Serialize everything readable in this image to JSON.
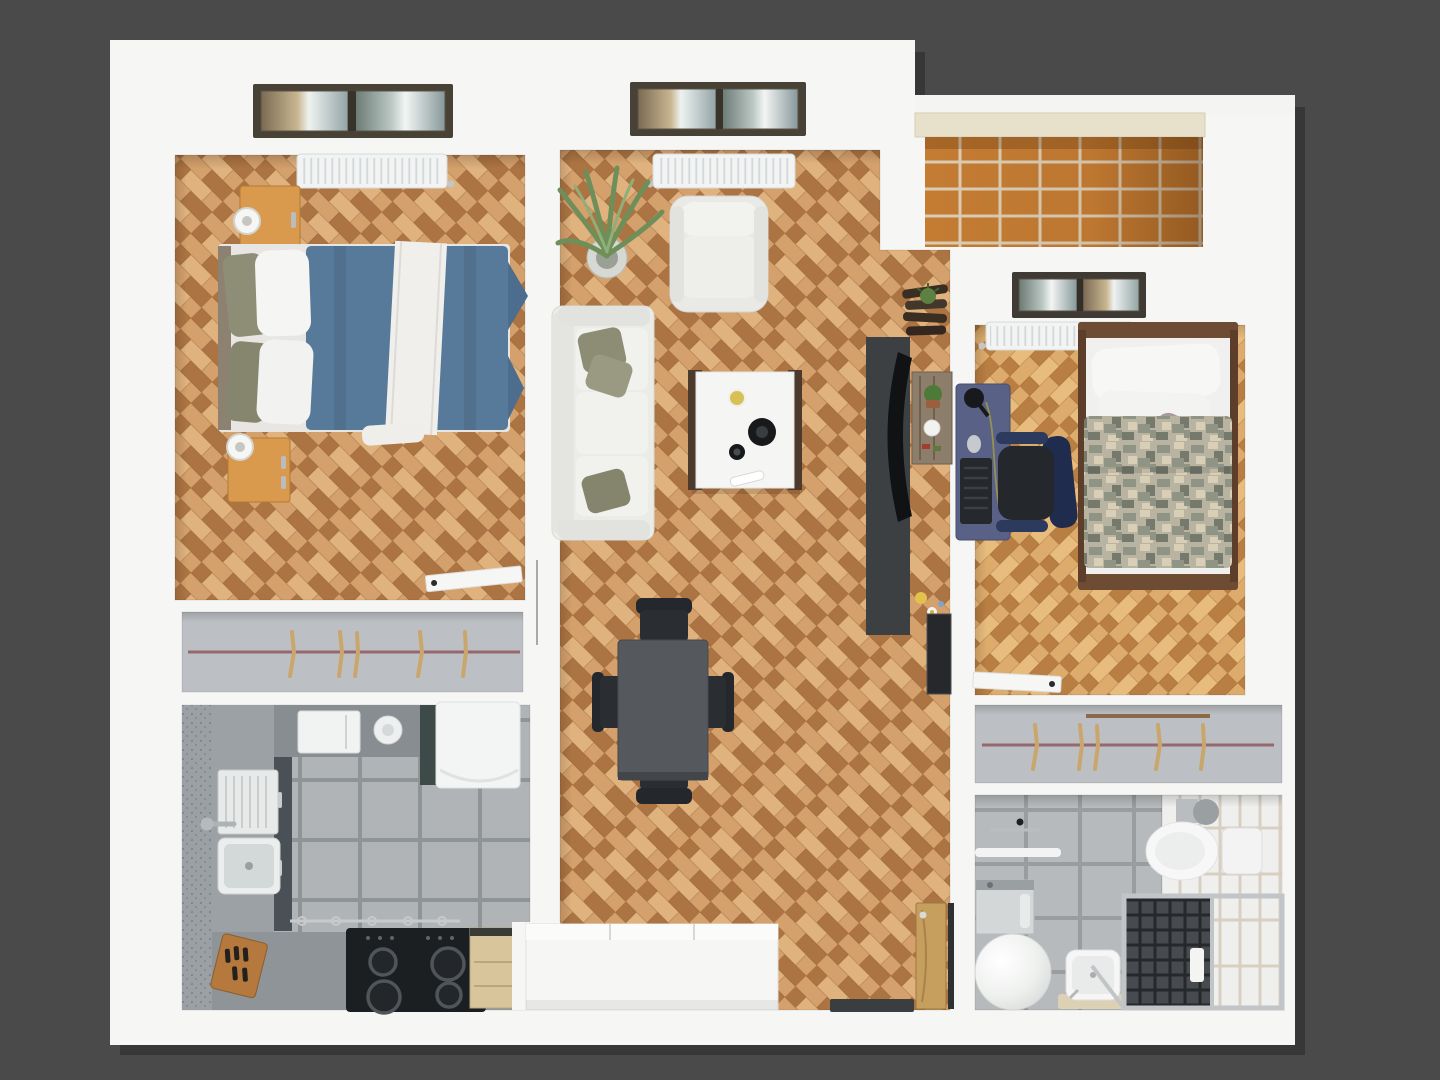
{
  "scene": {
    "description": "Top-down 3D architectural render of a two-bedroom apartment floor plan on a dark gray background. No text labels are visible in the image.",
    "view": "top-down 3D floor plan",
    "background_color": "#4a4a4b"
  },
  "palette": {
    "background": "#4a4a4b",
    "wall": "#f6f6f5",
    "parquet_light": "#d4a06b",
    "parquet_mid": "#c08a55",
    "parquet_dark": "#ad7443",
    "parquet_warm": "#e0b27e",
    "parquet2_light": "#ddab6b",
    "parquet2_mid": "#cb9454",
    "parquet2_dark": "#b87e42",
    "parquet2_warm": "#e8bc7d",
    "kitchen_tile": "#b0b4b7",
    "kitchen_grout": "#8f9497",
    "counter": "#9ba1a5",
    "counter_dark": "#878d90",
    "cabinet_dark": "#4a5156",
    "bath_tile": "#b6babc",
    "bath_grout": "#999da0",
    "white_tile": "#eff0ee",
    "white_tile_grout": "#d8cfc3",
    "balcony_tile": "#c47c33",
    "balcony_grout": "#dbccb4",
    "duvet_blue": "#587a9a",
    "duvet_blue_dark": "#4c6d8d",
    "camo_base": "#b8b4a1",
    "camo_green": "#8f9484",
    "camo_sand": "#d8cfb6",
    "camo_dark": "#757a6c",
    "wood_nightstand": "#d99a4e",
    "wood_bedframe": "#6e4b33",
    "wood_door": "#c69e5e",
    "wood_hanger": "#c9a66b",
    "closet_floor": "#bcc0c4",
    "closet_rail": "#96686e",
    "sofa_white": "#ebebe8",
    "pillow_olive": "#8d8d76",
    "table_dark": "#55595d",
    "chair_black": "#24272c",
    "tv_console": "#3c4043",
    "tv_black": "#101214",
    "desk_blue": "#5a6186",
    "chair_navy": "#2c3a5e",
    "radiator": "#f2f3f3",
    "window_frame": "#474136",
    "stove_black": "#1c1f22",
    "plant_green": "#6e8f5a",
    "mat_beige": "#ddd1b5"
  },
  "rooms": [
    {
      "id": "bedroom-1",
      "label": "Main bedroom with double bed",
      "floor": "herringbone parquet",
      "furniture": [
        "window",
        "white radiator",
        "double bed with blue duvet and white sheet",
        "white and olive pillows",
        "two orange wood nightstands",
        "two white table lamps",
        "open white door"
      ]
    },
    {
      "id": "living-room",
      "label": "Living room with dining area",
      "floor": "herringbone parquet",
      "furniture": [
        "window",
        "white radiator",
        "potted palm plant",
        "white armchair",
        "white three-seat sofa with olive cushions",
        "coffee table with bowls, candle and remote",
        "dark dining table with four black chairs",
        "dark TV console with curved TV",
        "rustic wall shelf with plant and mug",
        "corner spiral shelf with succulent",
        "dark wall mirror"
      ]
    },
    {
      "id": "bedroom-2",
      "label": "Second bedroom / office",
      "floor": "herringbone parquet",
      "furniture": [
        "window to balcony",
        "white radiator",
        "single bed with wooden frame and digital camo duvet",
        "white pillows and gray pillow",
        "dark blue computer desk with lamp, keyboard and mouse",
        "black office chair with navy armrests",
        "open white door"
      ]
    },
    {
      "id": "balcony",
      "label": "Balcony",
      "floor": "terracotta tiles",
      "furniture": [
        "parapet wall with cream coping"
      ]
    },
    {
      "id": "kitchen",
      "label": "Kitchen",
      "floor": "gray ceramic tiles",
      "furniture": [
        "L-shaped gray countertop",
        "sink with drainboard and chrome faucet",
        "black four-burner cooktop",
        "wooden knife block",
        "white microwave",
        "white countertop appliance",
        "white refrigerator",
        "dark lower cabinet fronts",
        "utensil rail with hooks",
        "light wood drawer unit"
      ]
    },
    {
      "id": "bathroom",
      "label": "Bathroom",
      "floor": "gray and white tiles",
      "furniture": [
        "toilet with cistern",
        "glass shower cabin with chrome frame",
        "washing machine",
        "white cylindrical water heater",
        "small white sink",
        "beige bath mat",
        "white towel rail"
      ]
    },
    {
      "id": "closet-left",
      "label": "Built-in wardrobe (left)",
      "floor": "gray",
      "furniture": [
        "clothes rail",
        "five wooden hangers"
      ]
    },
    {
      "id": "closet-right",
      "label": "Built-in wardrobe (right)",
      "floor": "gray",
      "furniture": [
        "clothes rail",
        "five wooden hangers"
      ]
    },
    {
      "id": "entrance-hall",
      "label": "Entrance hall",
      "floor": "herringbone parquet",
      "furniture": [
        "white sideboard",
        "wooden entrance door with chrome handle",
        "dark doormat"
      ]
    }
  ]
}
